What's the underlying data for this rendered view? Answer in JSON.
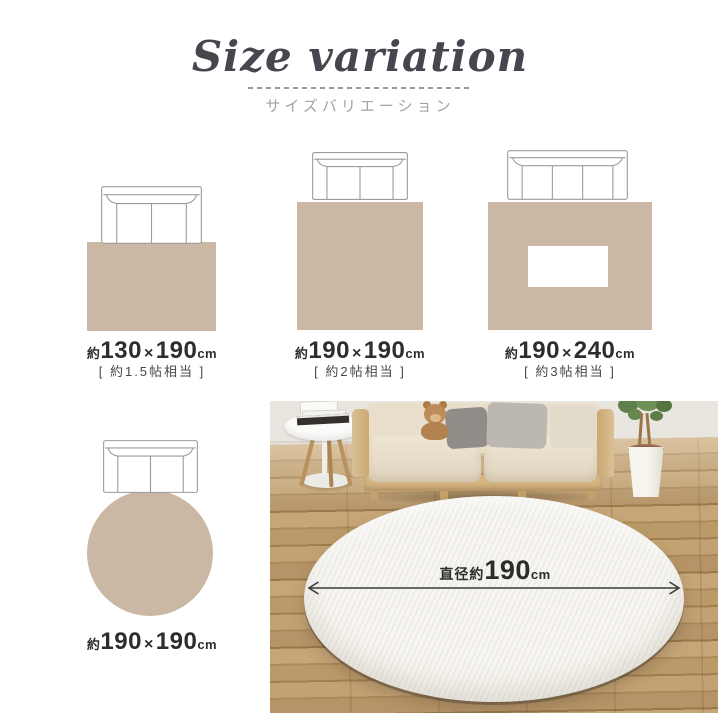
{
  "header": {
    "title": "Size variation",
    "subtitle": "サイズバリエーション"
  },
  "sizes": [
    {
      "shape": "rectangle",
      "approx": "約",
      "width": "130",
      "times": "×",
      "height": "190",
      "unit": "cm",
      "tatami_note": "[ 約1.5帖相当 ]"
    },
    {
      "shape": "square",
      "approx": "約",
      "width": "190",
      "times": "×",
      "height": "190",
      "unit": "cm",
      "tatami_note": "[ 約2帖相当 ]"
    },
    {
      "shape": "rectangle-with-table",
      "approx": "約",
      "width": "190",
      "times": "×",
      "height": "240",
      "unit": "cm",
      "tatami_note": "[ 約3帖相当 ]"
    },
    {
      "shape": "circle",
      "approx": "約",
      "width": "190",
      "times": "×",
      "height": "190",
      "unit": "cm",
      "tatami_note": ""
    }
  ],
  "photo": {
    "dimension": {
      "prefix": "直径約",
      "value": "190",
      "unit": "cm"
    }
  },
  "colors": {
    "rug_beige": "#cbb8a4",
    "line_gray": "#9c9c9a",
    "title_dark": "#46464e",
    "subtitle_gray": "#a3a3a3",
    "label_dark": "#2d2d2d",
    "note_gray": "#474747",
    "photo_rug_white": "#f7f6f1"
  }
}
